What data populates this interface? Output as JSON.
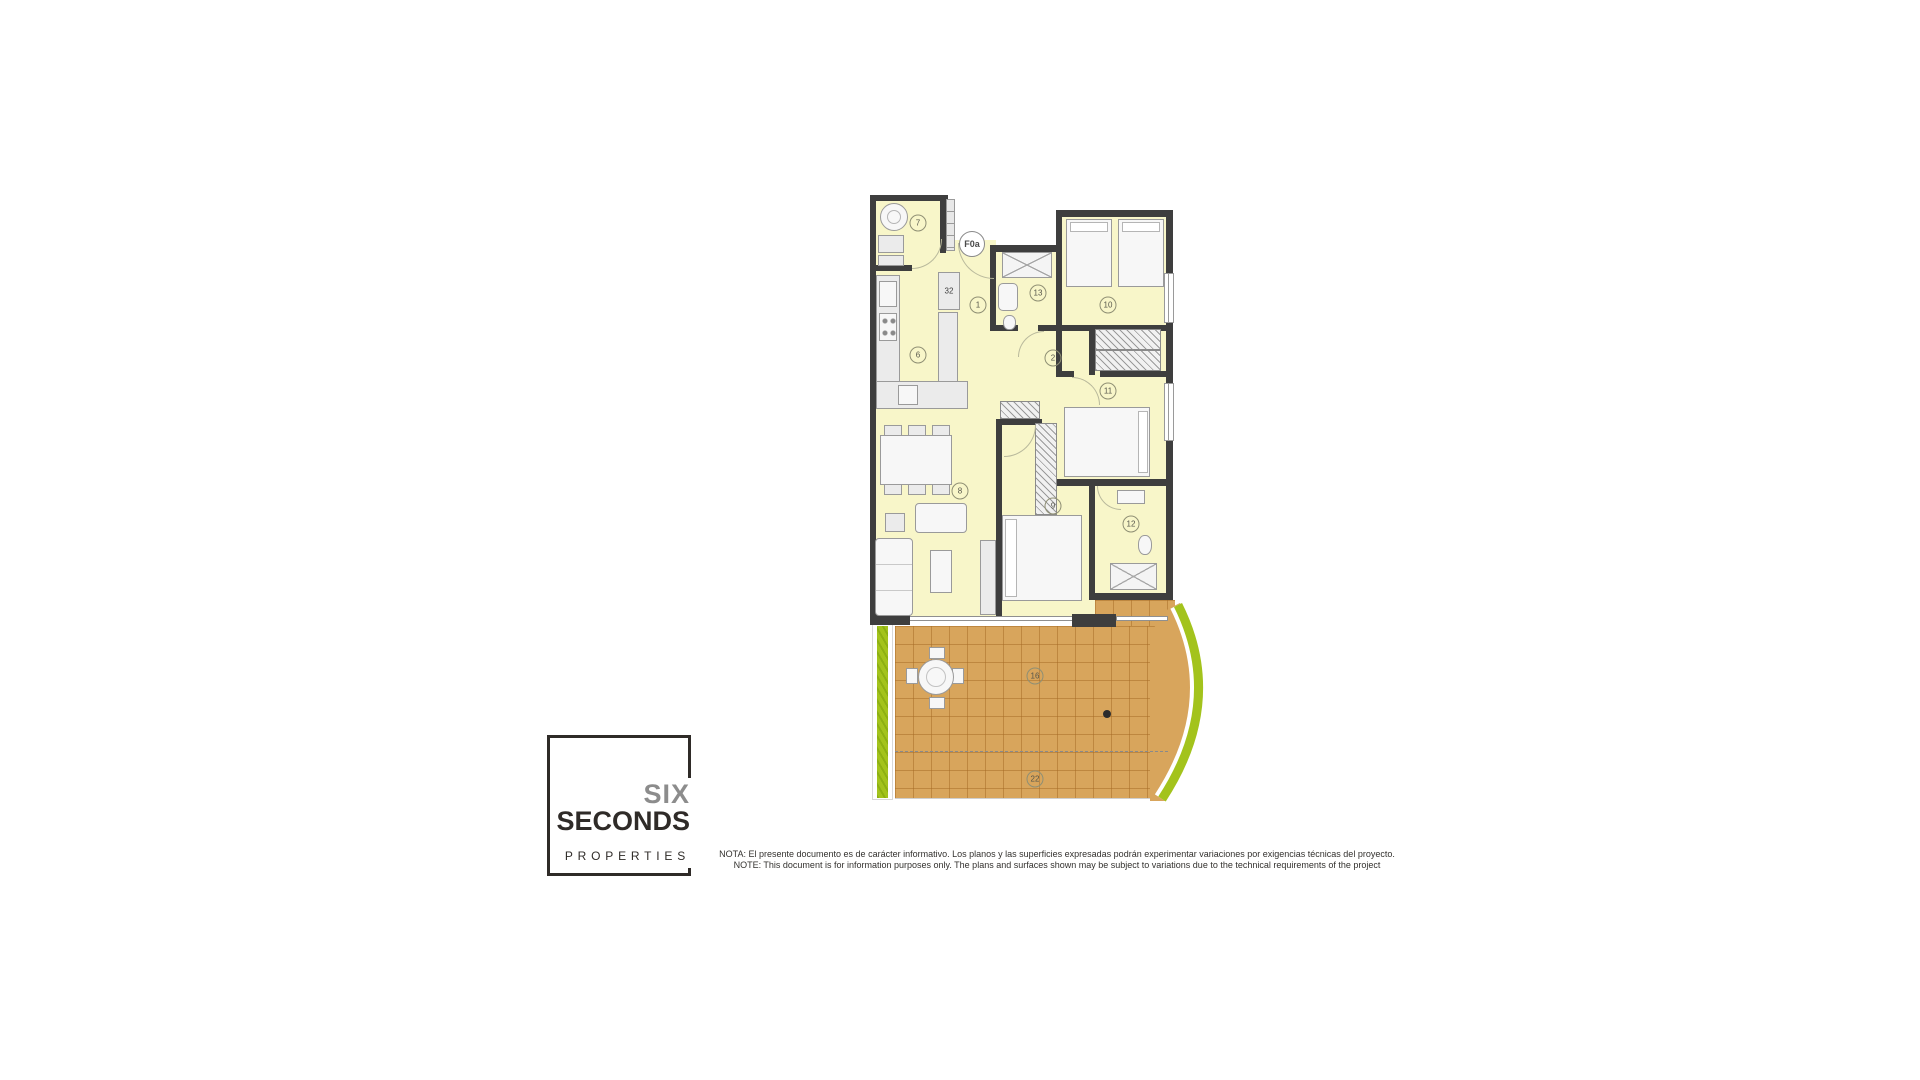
{
  "colors": {
    "wall": "#3e3e3e",
    "room": "#f8f6c9",
    "terrace": "#d8a55c",
    "planter": "#a3c31c",
    "logo_dark": "#2f2b28",
    "logo_gray": "#8c8c8c"
  },
  "floorplan": {
    "unit_label": "F0a",
    "shaft_label": "32",
    "labels": [
      "7",
      "1",
      "6",
      "13",
      "10",
      "2",
      "11",
      "8",
      "9",
      "12",
      "16",
      "22"
    ]
  },
  "logo": {
    "line1": "SIX",
    "line2": "SECONDS",
    "line3": "PROPERTIES"
  },
  "disclaimer": {
    "line_es": "NOTA: El presente documento es de carácter informativo. Los planos y las superficies expresadas podrán experimentar variaciones por exigencias técnicas del proyecto.",
    "line_en": "NOTE: This document is for information purposes only. The plans and surfaces shown may be subject to variations due to the technical requirements of the project"
  }
}
